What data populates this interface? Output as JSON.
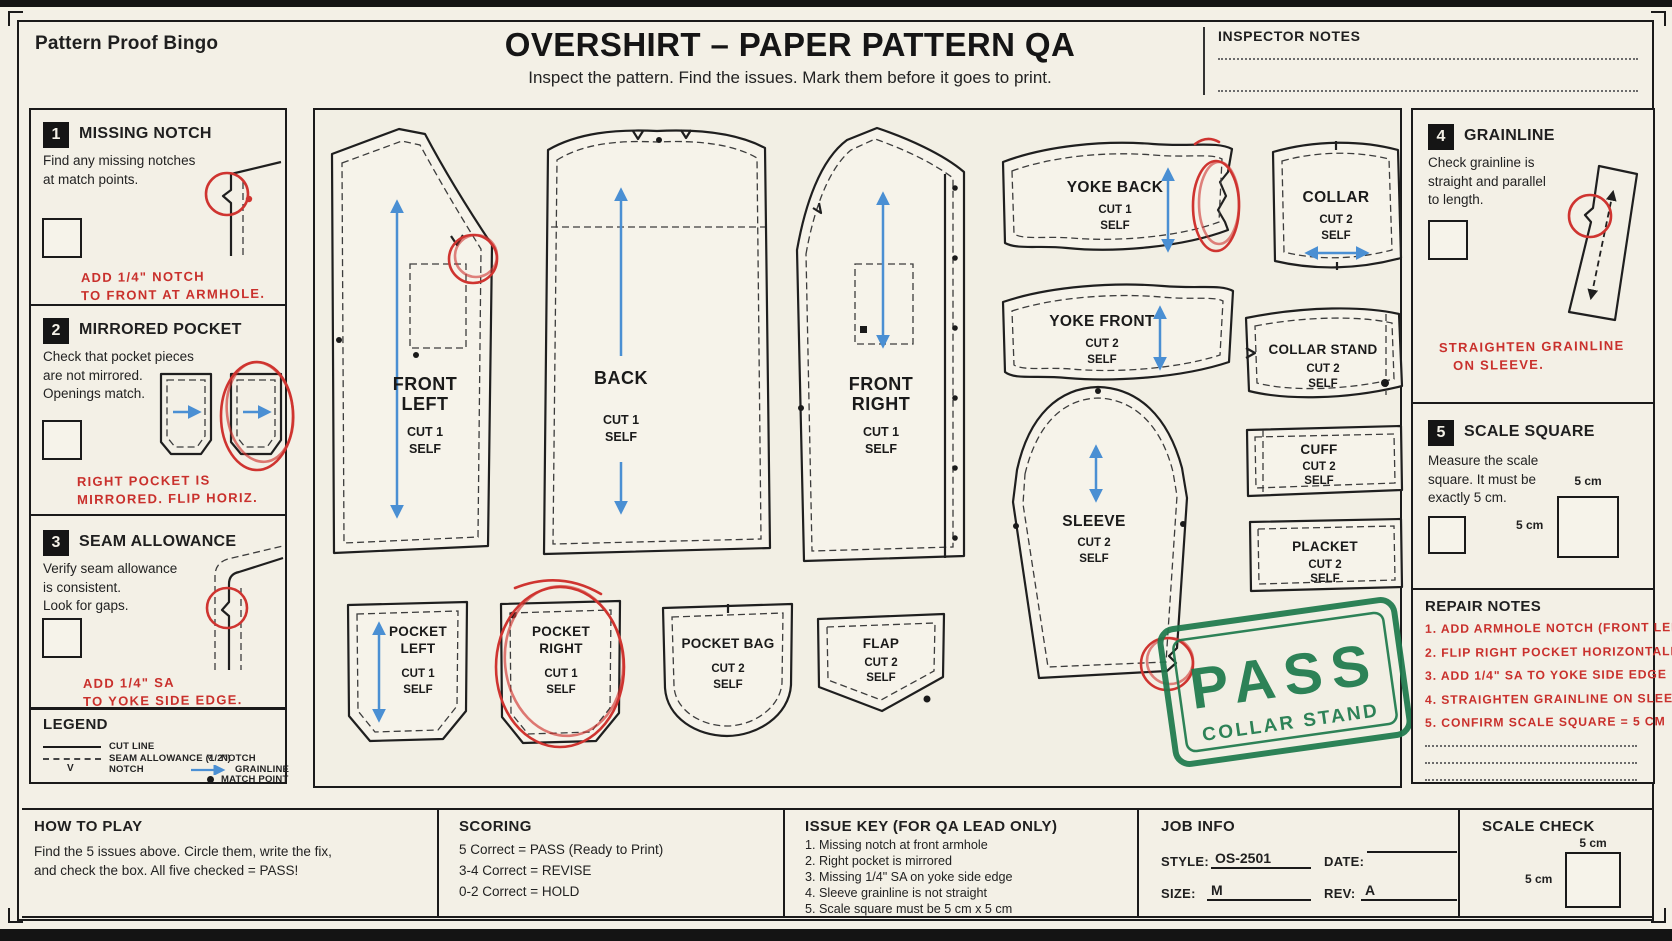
{
  "header": {
    "brand": "Pattern Proof Bingo",
    "title": "OVERSHIRT – PAPER PATTERN QA",
    "subtitle": "Inspect the pattern. Find the issues. Mark them before it goes to print.",
    "inspector_notes": "INSPECTOR NOTES"
  },
  "checks": {
    "c1": {
      "num": "1",
      "title": "MISSING NOTCH",
      "desc": [
        "Find any missing notches",
        "at match points."
      ],
      "note1": "ADD 1/4\" NOTCH",
      "note2": "TO FRONT AT ARMHOLE."
    },
    "c2": {
      "num": "2",
      "title": "MIRRORED POCKET",
      "desc": [
        "Check that pocket pieces",
        "are not mirrored.",
        "Openings match."
      ],
      "note1": "RIGHT POCKET IS",
      "note2": "MIRRORED. FLIP HORIZ."
    },
    "c3": {
      "num": "3",
      "title": "SEAM ALLOWANCE",
      "desc": [
        "Verify seam allowance",
        "is consistent.",
        "Look for gaps."
      ],
      "note1": "ADD 1/4\" SA",
      "note2": "TO YOKE SIDE EDGE."
    },
    "c4": {
      "num": "4",
      "title": "GRAINLINE",
      "desc": [
        "Check grainline is",
        "straight and parallel",
        "to length."
      ],
      "note1": "STRAIGHTEN GRAINLINE",
      "note2": "ON SLEEVE."
    },
    "c5": {
      "num": "5",
      "title": "SCALE SQUARE",
      "desc": [
        "Measure the scale",
        "square. It must be",
        "exactly 5 cm."
      ],
      "sq_top": "5 cm",
      "sq_left": "5 cm"
    }
  },
  "legend": {
    "title": "LEGEND",
    "cut_line": "CUT LINE",
    "seam_allowance": "SEAM ALLOWANCE (1/2\")",
    "notch_left_sym": "V",
    "notch_left": "NOTCH",
    "notch_right_sym": "▿",
    "notch_right": "NOTCH",
    "grainline": "GRAINLINE",
    "match_point": "MATCH POINT"
  },
  "pieces": {
    "front_left": {
      "l1": "FRONT",
      "l2": "LEFT",
      "cut": "CUT 1",
      "self": "SELF"
    },
    "back": {
      "l1": "BACK",
      "cut": "CUT 1",
      "self": "SELF"
    },
    "front_right": {
      "l1": "FRONT",
      "l2": "RIGHT",
      "cut": "CUT 1",
      "self": "SELF"
    },
    "yoke_back": {
      "l1": "YOKE BACK",
      "cut": "CUT 1",
      "self": "SELF"
    },
    "collar": {
      "l1": "COLLAR",
      "cut": "CUT 2",
      "self": "SELF"
    },
    "yoke_front": {
      "l1": "YOKE FRONT",
      "cut": "CUT 2",
      "self": "SELF"
    },
    "collar_stand": {
      "l1": "COLLAR STAND",
      "cut": "CUT 2",
      "self": "SELF"
    },
    "cuff": {
      "l1": "CUFF",
      "cut": "CUT 2",
      "self": "SELF"
    },
    "sleeve": {
      "l1": "SLEEVE",
      "cut": "CUT 2",
      "self": "SELF"
    },
    "placket": {
      "l1": "PLACKET",
      "cut": "CUT 2",
      "self": "SELF"
    },
    "pocket_left": {
      "l1": "POCKET",
      "l2": "LEFT",
      "cut": "CUT 1",
      "self": "SELF"
    },
    "pocket_right": {
      "l1": "POCKET",
      "l2": "RIGHT",
      "cut": "CUT 1",
      "self": "SELF"
    },
    "pocket_bag": {
      "l1": "POCKET BAG",
      "cut": "CUT 2",
      "self": "SELF"
    },
    "flap": {
      "l1": "FLAP",
      "cut": "CUT 2",
      "self": "SELF"
    }
  },
  "stamp": {
    "word": "PASS",
    "sub": "COLLAR STAND"
  },
  "repair": {
    "title": "REPAIR NOTES",
    "items": [
      "1. ADD ARMHOLE NOTCH (FRONT LEFT)",
      "2. FLIP RIGHT POCKET HORIZONTALLY",
      "3. ADD 1/4\" SA TO YOKE SIDE EDGE",
      "4. STRAIGHTEN GRAINLINE ON SLEEVE",
      "5. CONFIRM SCALE SQUARE = 5 CM"
    ]
  },
  "how_to_play": {
    "title": "HOW TO PLAY",
    "line1": "Find the 5 issues above. Circle them, write the fix,",
    "line2": "and check the box. All five checked = PASS!"
  },
  "scoring": {
    "title": "SCORING",
    "lines": [
      "5 Correct  =  PASS (Ready to Print)",
      "3-4 Correct  =  REVISE",
      "0-2 Correct  =  HOLD"
    ]
  },
  "issue_key": {
    "title": "ISSUE KEY (FOR QA LEAD ONLY)",
    "items": [
      "1.  Missing notch at front armhole",
      "2.  Right pocket is mirrored",
      "3.  Missing 1/4\" SA on yoke side edge",
      "4.  Sleeve grainline is not straight",
      "5.  Scale square must be 5 cm x 5 cm"
    ]
  },
  "job_info": {
    "title": "JOB INFO",
    "style_label": "STYLE:",
    "style_value": "OS-2501",
    "date_label": "DATE:",
    "date_value": "",
    "size_label": "SIZE:",
    "size_value": "M",
    "rev_label": "REV:",
    "rev_value": "A"
  },
  "scale_check": {
    "title": "SCALE CHECK",
    "top": "5 cm",
    "left": "5 cm"
  },
  "colors": {
    "paper": "#f3f0e6",
    "ink": "#1f1f1f",
    "red": "#c9302c",
    "blue": "#4a8fd3",
    "green": "#1f7a4d"
  }
}
